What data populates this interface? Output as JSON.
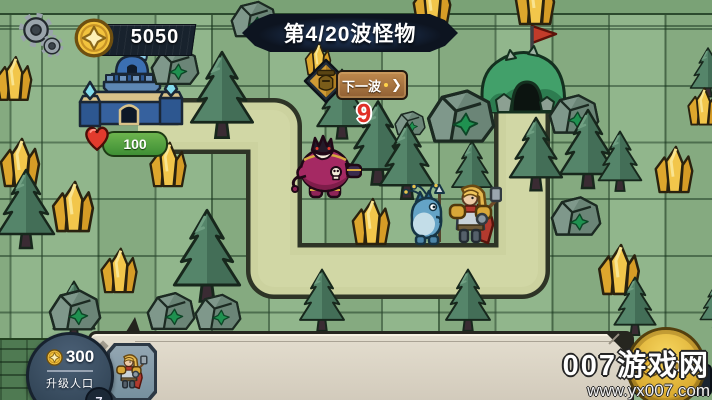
{
  "hud": {
    "gold_amount": "5050",
    "wave_title": "第4/20波怪物",
    "next_wave": {
      "label": "下一波",
      "arrow": "❯"
    },
    "wave_countdown": "9",
    "castle_hp": "100"
  },
  "bottom": {
    "population": {
      "amount": "300",
      "label": "升级人口",
      "level": "7"
    },
    "buy_coin": {
      "price": "100"
    }
  },
  "watermark": {
    "site": "007游戏网",
    "url": "www.yx007.com"
  },
  "icons": {
    "settings": "gear-icon",
    "currency": "coin-icon",
    "health": "heart-icon",
    "wave_marker": "helmet-badge-icon"
  },
  "colors": {
    "tile_green": "#8bb286",
    "path_tan": "#ccd29f",
    "banner_dark": "#0d1420",
    "gold": "#f2c33e",
    "hp_green": "#4f9c35",
    "alert_red": "#e03127"
  }
}
